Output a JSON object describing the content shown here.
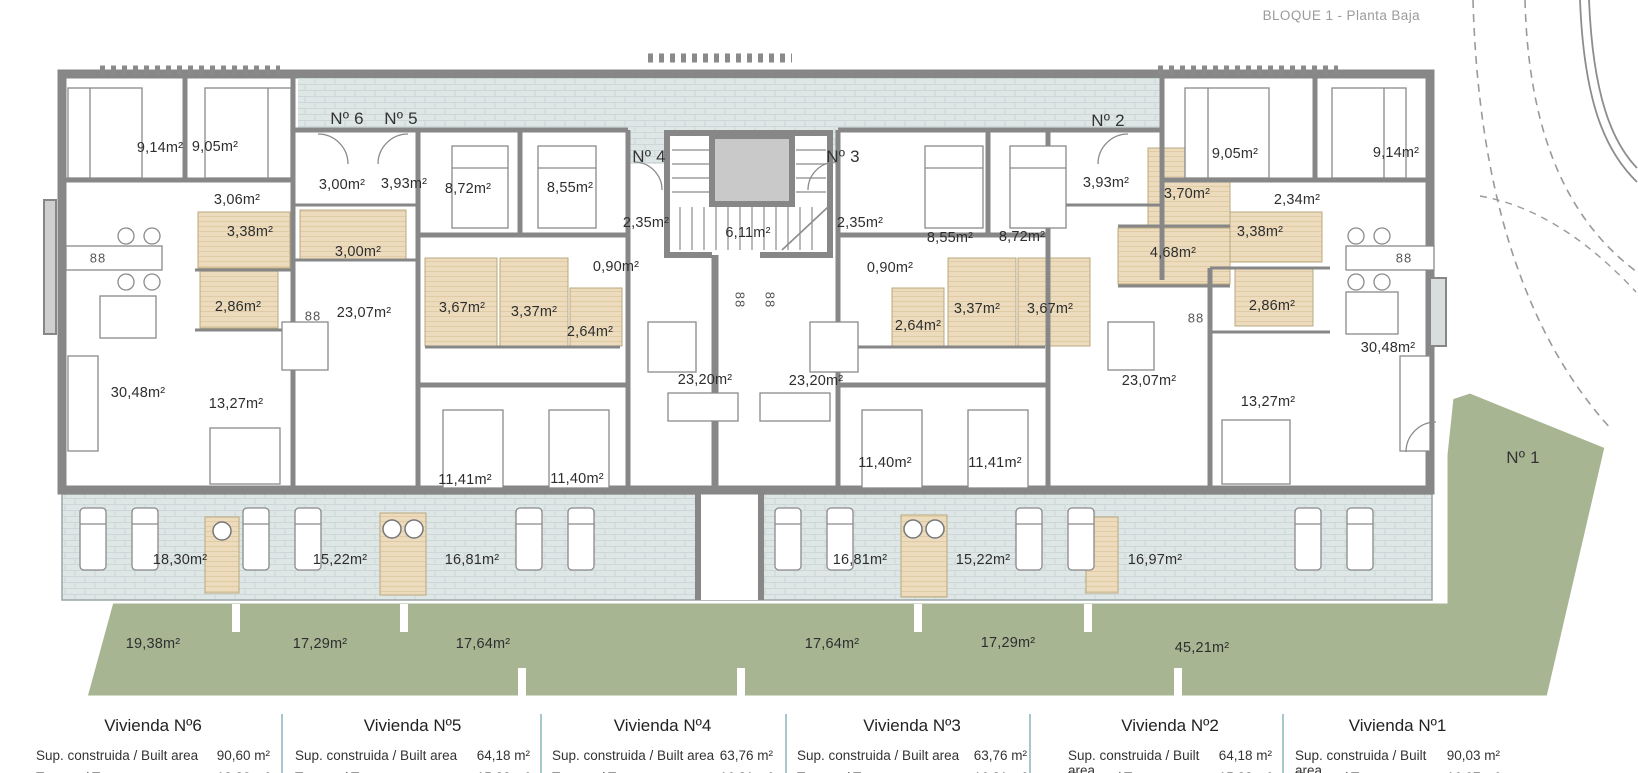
{
  "title": "BLOQUE 1 - Planta Baja",
  "colors": {
    "wall": "#878787",
    "deck_tile": "#dee6e6",
    "bathroom_floor": "#ecdcbd",
    "garden": "#a8b592",
    "legend_divider": "#a8c6ce"
  },
  "plan": {
    "unit_labels": [
      {
        "text": "Nº 6",
        "x": 347,
        "y": 119
      },
      {
        "text": "Nº 5",
        "x": 401,
        "y": 119
      },
      {
        "text": "Nº 4",
        "x": 649,
        "y": 157
      },
      {
        "text": "Nº 3",
        "x": 843,
        "y": 157
      },
      {
        "text": "Nº 2",
        "x": 1108,
        "y": 121
      },
      {
        "text": "Nº 1",
        "x": 1523,
        "y": 458
      }
    ],
    "room_labels": [
      {
        "text": "9,14m²",
        "x": 160,
        "y": 148
      },
      {
        "text": "9,05m²",
        "x": 215,
        "y": 147
      },
      {
        "text": "3,06m²",
        "x": 237,
        "y": 200
      },
      {
        "text": "3,38m²",
        "x": 250,
        "y": 232
      },
      {
        "text": "2,86m²",
        "x": 238,
        "y": 307
      },
      {
        "text": "30,48m²",
        "x": 138,
        "y": 393
      },
      {
        "text": "13,27m²",
        "x": 236,
        "y": 404
      },
      {
        "text": "3,00m²",
        "x": 342,
        "y": 185
      },
      {
        "text": "3,93m²",
        "x": 404,
        "y": 184
      },
      {
        "text": "3,00m²",
        "x": 358,
        "y": 252
      },
      {
        "text": "23,07m²",
        "x": 364,
        "y": 313
      },
      {
        "text": "8,72m²",
        "x": 468,
        "y": 189
      },
      {
        "text": "8,55m²",
        "x": 570,
        "y": 188
      },
      {
        "text": "3,67m²",
        "x": 462,
        "y": 308
      },
      {
        "text": "3,37m²",
        "x": 534,
        "y": 312
      },
      {
        "text": "2,64m²",
        "x": 590,
        "y": 332
      },
      {
        "text": "11,41m²",
        "x": 465,
        "y": 480
      },
      {
        "text": "11,40m²",
        "x": 577,
        "y": 479
      },
      {
        "text": "2,35m²",
        "x": 646,
        "y": 223
      },
      {
        "text": "0,90m²",
        "x": 616,
        "y": 267
      },
      {
        "text": "6,11m²",
        "x": 748,
        "y": 233
      },
      {
        "text": "2,35m²",
        "x": 860,
        "y": 223
      },
      {
        "text": "0,90m²",
        "x": 890,
        "y": 268
      },
      {
        "text": "23,20m²",
        "x": 705,
        "y": 380
      },
      {
        "text": "23,20m²",
        "x": 816,
        "y": 381
      },
      {
        "text": "8,55m²",
        "x": 950,
        "y": 238
      },
      {
        "text": "8,72m²",
        "x": 1022,
        "y": 237
      },
      {
        "text": "2,64m²",
        "x": 918,
        "y": 326
      },
      {
        "text": "3,37m²",
        "x": 977,
        "y": 309
      },
      {
        "text": "3,67m²",
        "x": 1050,
        "y": 309
      },
      {
        "text": "11,40m²",
        "x": 885,
        "y": 463
      },
      {
        "text": "11,41m²",
        "x": 995,
        "y": 463
      },
      {
        "text": "3,93m²",
        "x": 1106,
        "y": 183
      },
      {
        "text": "3,70m²",
        "x": 1187,
        "y": 194
      },
      {
        "text": "9,05m²",
        "x": 1235,
        "y": 154
      },
      {
        "text": "2,34m²",
        "x": 1297,
        "y": 200
      },
      {
        "text": "3,38m²",
        "x": 1260,
        "y": 232
      },
      {
        "text": "4,68m²",
        "x": 1173,
        "y": 253
      },
      {
        "text": "2,86m²",
        "x": 1272,
        "y": 306
      },
      {
        "text": "23,07m²",
        "x": 1149,
        "y": 381
      },
      {
        "text": "13,27m²",
        "x": 1268,
        "y": 402
      },
      {
        "text": "9,14m²",
        "x": 1396,
        "y": 153
      },
      {
        "text": "30,48m²",
        "x": 1388,
        "y": 348
      }
    ],
    "terrace_labels": [
      {
        "text": "18,30m²",
        "x": 180,
        "y": 560
      },
      {
        "text": "15,22m²",
        "x": 340,
        "y": 560
      },
      {
        "text": "16,81m²",
        "x": 472,
        "y": 560
      },
      {
        "text": "16,81m²",
        "x": 860,
        "y": 560
      },
      {
        "text": "15,22m²",
        "x": 983,
        "y": 560
      },
      {
        "text": "16,97m²",
        "x": 1155,
        "y": 560
      }
    ],
    "garden_labels": [
      {
        "text": "19,38m²",
        "x": 153,
        "y": 644
      },
      {
        "text": "17,29m²",
        "x": 320,
        "y": 644
      },
      {
        "text": "17,64m²",
        "x": 483,
        "y": 644
      },
      {
        "text": "17,64m²",
        "x": 832,
        "y": 644
      },
      {
        "text": "17,29m²",
        "x": 1008,
        "y": 643
      },
      {
        "text": "45,21m²",
        "x": 1202,
        "y": 648
      }
    ],
    "stove_symbols": [
      {
        "text": "88",
        "x": 98,
        "y": 258,
        "v": false
      },
      {
        "text": "88",
        "x": 313,
        "y": 316,
        "v": false
      },
      {
        "text": "88",
        "x": 740,
        "y": 300,
        "v": true
      },
      {
        "text": "88",
        "x": 770,
        "y": 300,
        "v": true
      },
      {
        "text": "88",
        "x": 1196,
        "y": 318,
        "v": false
      },
      {
        "text": "88",
        "x": 1404,
        "y": 258,
        "v": false
      }
    ]
  },
  "legend": {
    "built_label": "Sup. construida / Built area",
    "terrace_label": "Terraza / Terrace",
    "units": [
      {
        "name": "Vivienda Nº6",
        "built": "90,60 m²",
        "terrace": "18,30 m²"
      },
      {
        "name": "Vivienda Nº5",
        "built": "64,18 m²",
        "terrace": "15,22 m²"
      },
      {
        "name": "Vivienda Nº4",
        "built": "63,76 m²",
        "terrace": "16,81 m²"
      },
      {
        "name": "Vivienda Nº3",
        "built": "63,76 m²",
        "terrace": "16,81 m²"
      },
      {
        "name": "Vivienda Nº2",
        "built": "64,18 m²",
        "terrace": "15,22 m²"
      },
      {
        "name": "Vivienda Nº1",
        "built": "90,03 m²",
        "terrace": "16,97 m²"
      }
    ]
  }
}
